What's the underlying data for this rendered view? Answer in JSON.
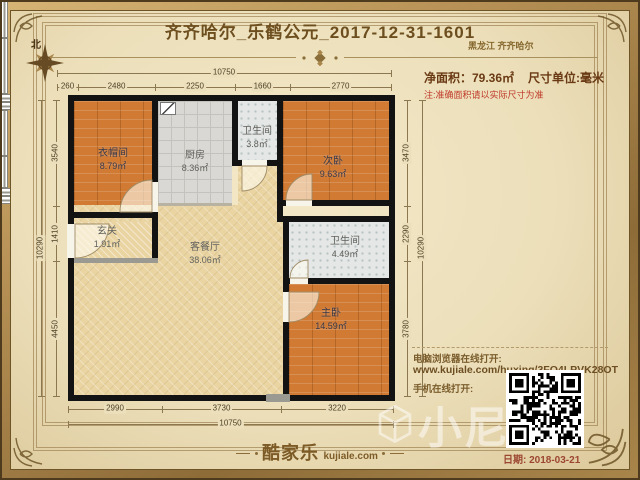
{
  "header": {
    "title": "齐齐哈尔_乐鹤公元_2017-12-31-1601",
    "region": "黑龙江 齐齐哈尔",
    "net_area": "净面积：79.36㎡",
    "unit": "尺寸单位:毫米",
    "note": "注:准确面积请以实际尺寸为准"
  },
  "compass": {
    "north_label": "北"
  },
  "rooms": {
    "closet": {
      "name": "衣帽间",
      "area": "8.79㎡"
    },
    "kitchen": {
      "name": "厨房",
      "area": "8.36㎡"
    },
    "bath_top": {
      "name": "卫生间",
      "area": "3.8㎡"
    },
    "bedroom_second": {
      "name": "次卧",
      "area": "9.63㎡"
    },
    "entry": {
      "name": "玄关",
      "area": "1.91㎡"
    },
    "living_dining": {
      "name": "客餐厅",
      "area": "38.06㎡"
    },
    "bath_master": {
      "name": "卫生间",
      "area": "4.49㎡"
    },
    "bedroom_master": {
      "name": "主卧",
      "area": "14.59㎡"
    }
  },
  "dimensions": {
    "top_total": "10750",
    "top_segments": [
      "260",
      "2480",
      "2250",
      "1660",
      "2770"
    ],
    "bottom_total": "10750",
    "bottom_segments": [
      "2990",
      "3730",
      "3220"
    ],
    "left_total": "10290",
    "left_segments": [
      "3540",
      "1410",
      "4450"
    ],
    "right_total": "10290",
    "right_segments": [
      "3470",
      "2290",
      "3780"
    ]
  },
  "share": {
    "pc_label": "电脑浏览器在线打开:",
    "url": "www.kujiale.com/huxing/3FO4LPVK28OT",
    "mobile_label": "手机在线打开:"
  },
  "footer": {
    "logo_cn": "酷家乐",
    "logo_en": "kujiale.com",
    "date": "日期: 2018-03-21"
  },
  "watermark": {
    "text": "小尼"
  }
}
